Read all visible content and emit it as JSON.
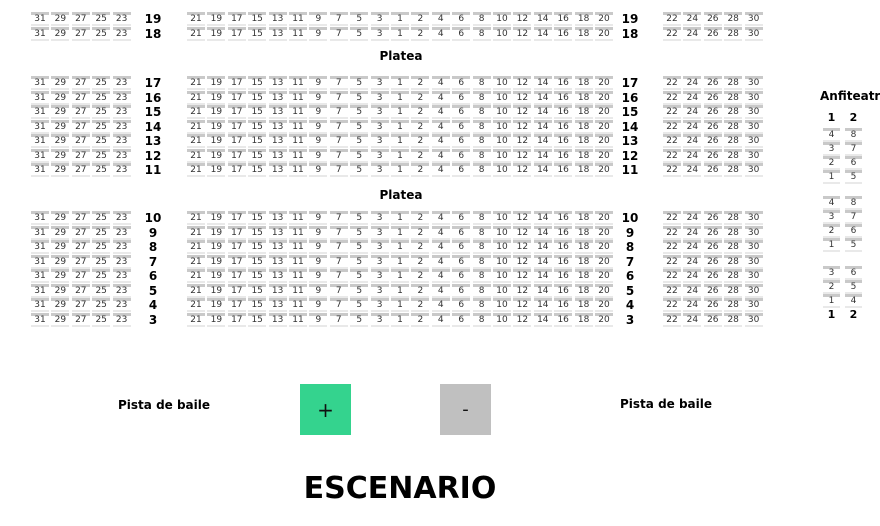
{
  "stage": {
    "label": "ESCENARIO"
  },
  "dance_floor": {
    "left_label": "Pista de baile",
    "right_label": "Pista de baile"
  },
  "controls": {
    "zoom_in_label": "+",
    "zoom_out_label": "-"
  },
  "colors": {
    "zoom_in_bg": "#34d38e",
    "zoom_out_bg": "#c0c0c0",
    "seat_back": "#c9c9c9",
    "seat_base": "#e9e9e9"
  },
  "platea": {
    "section_label": "Platea",
    "left_section_seats": [
      "31",
      "29",
      "27",
      "25",
      "23"
    ],
    "center_section_seats": [
      "21",
      "19",
      "17",
      "15",
      "13",
      "11",
      "9",
      "7",
      "5",
      "3",
      "1",
      "2",
      "4",
      "6",
      "8",
      "10",
      "12",
      "14",
      "16",
      "18",
      "20"
    ],
    "right_section_seats": [
      "22",
      "24",
      "26",
      "28",
      "30"
    ],
    "row_blocks": [
      {
        "rows": [
          "19",
          "18"
        ]
      },
      {
        "rows": [
          "17",
          "16",
          "15",
          "14",
          "13",
          "12",
          "11"
        ]
      },
      {
        "rows": [
          "10",
          "9",
          "8",
          "7",
          "6",
          "5",
          "4",
          "3"
        ]
      }
    ]
  },
  "anfiteatro": {
    "title": "Anfiteatro",
    "column_headers": [
      "1",
      "2"
    ],
    "seat_groups": [
      {
        "rows": [
          [
            "4",
            "8"
          ],
          [
            "3",
            "7"
          ],
          [
            "2",
            "6"
          ],
          [
            "1",
            "5"
          ]
        ]
      },
      {
        "rows": [
          [
            "4",
            "8"
          ],
          [
            "3",
            "7"
          ],
          [
            "2",
            "6"
          ],
          [
            "1",
            "5"
          ]
        ]
      },
      {
        "rows": [
          [
            "3",
            "6"
          ],
          [
            "2",
            "5"
          ],
          [
            "1",
            "4"
          ]
        ]
      }
    ],
    "column_footers": [
      "1",
      "2"
    ]
  }
}
